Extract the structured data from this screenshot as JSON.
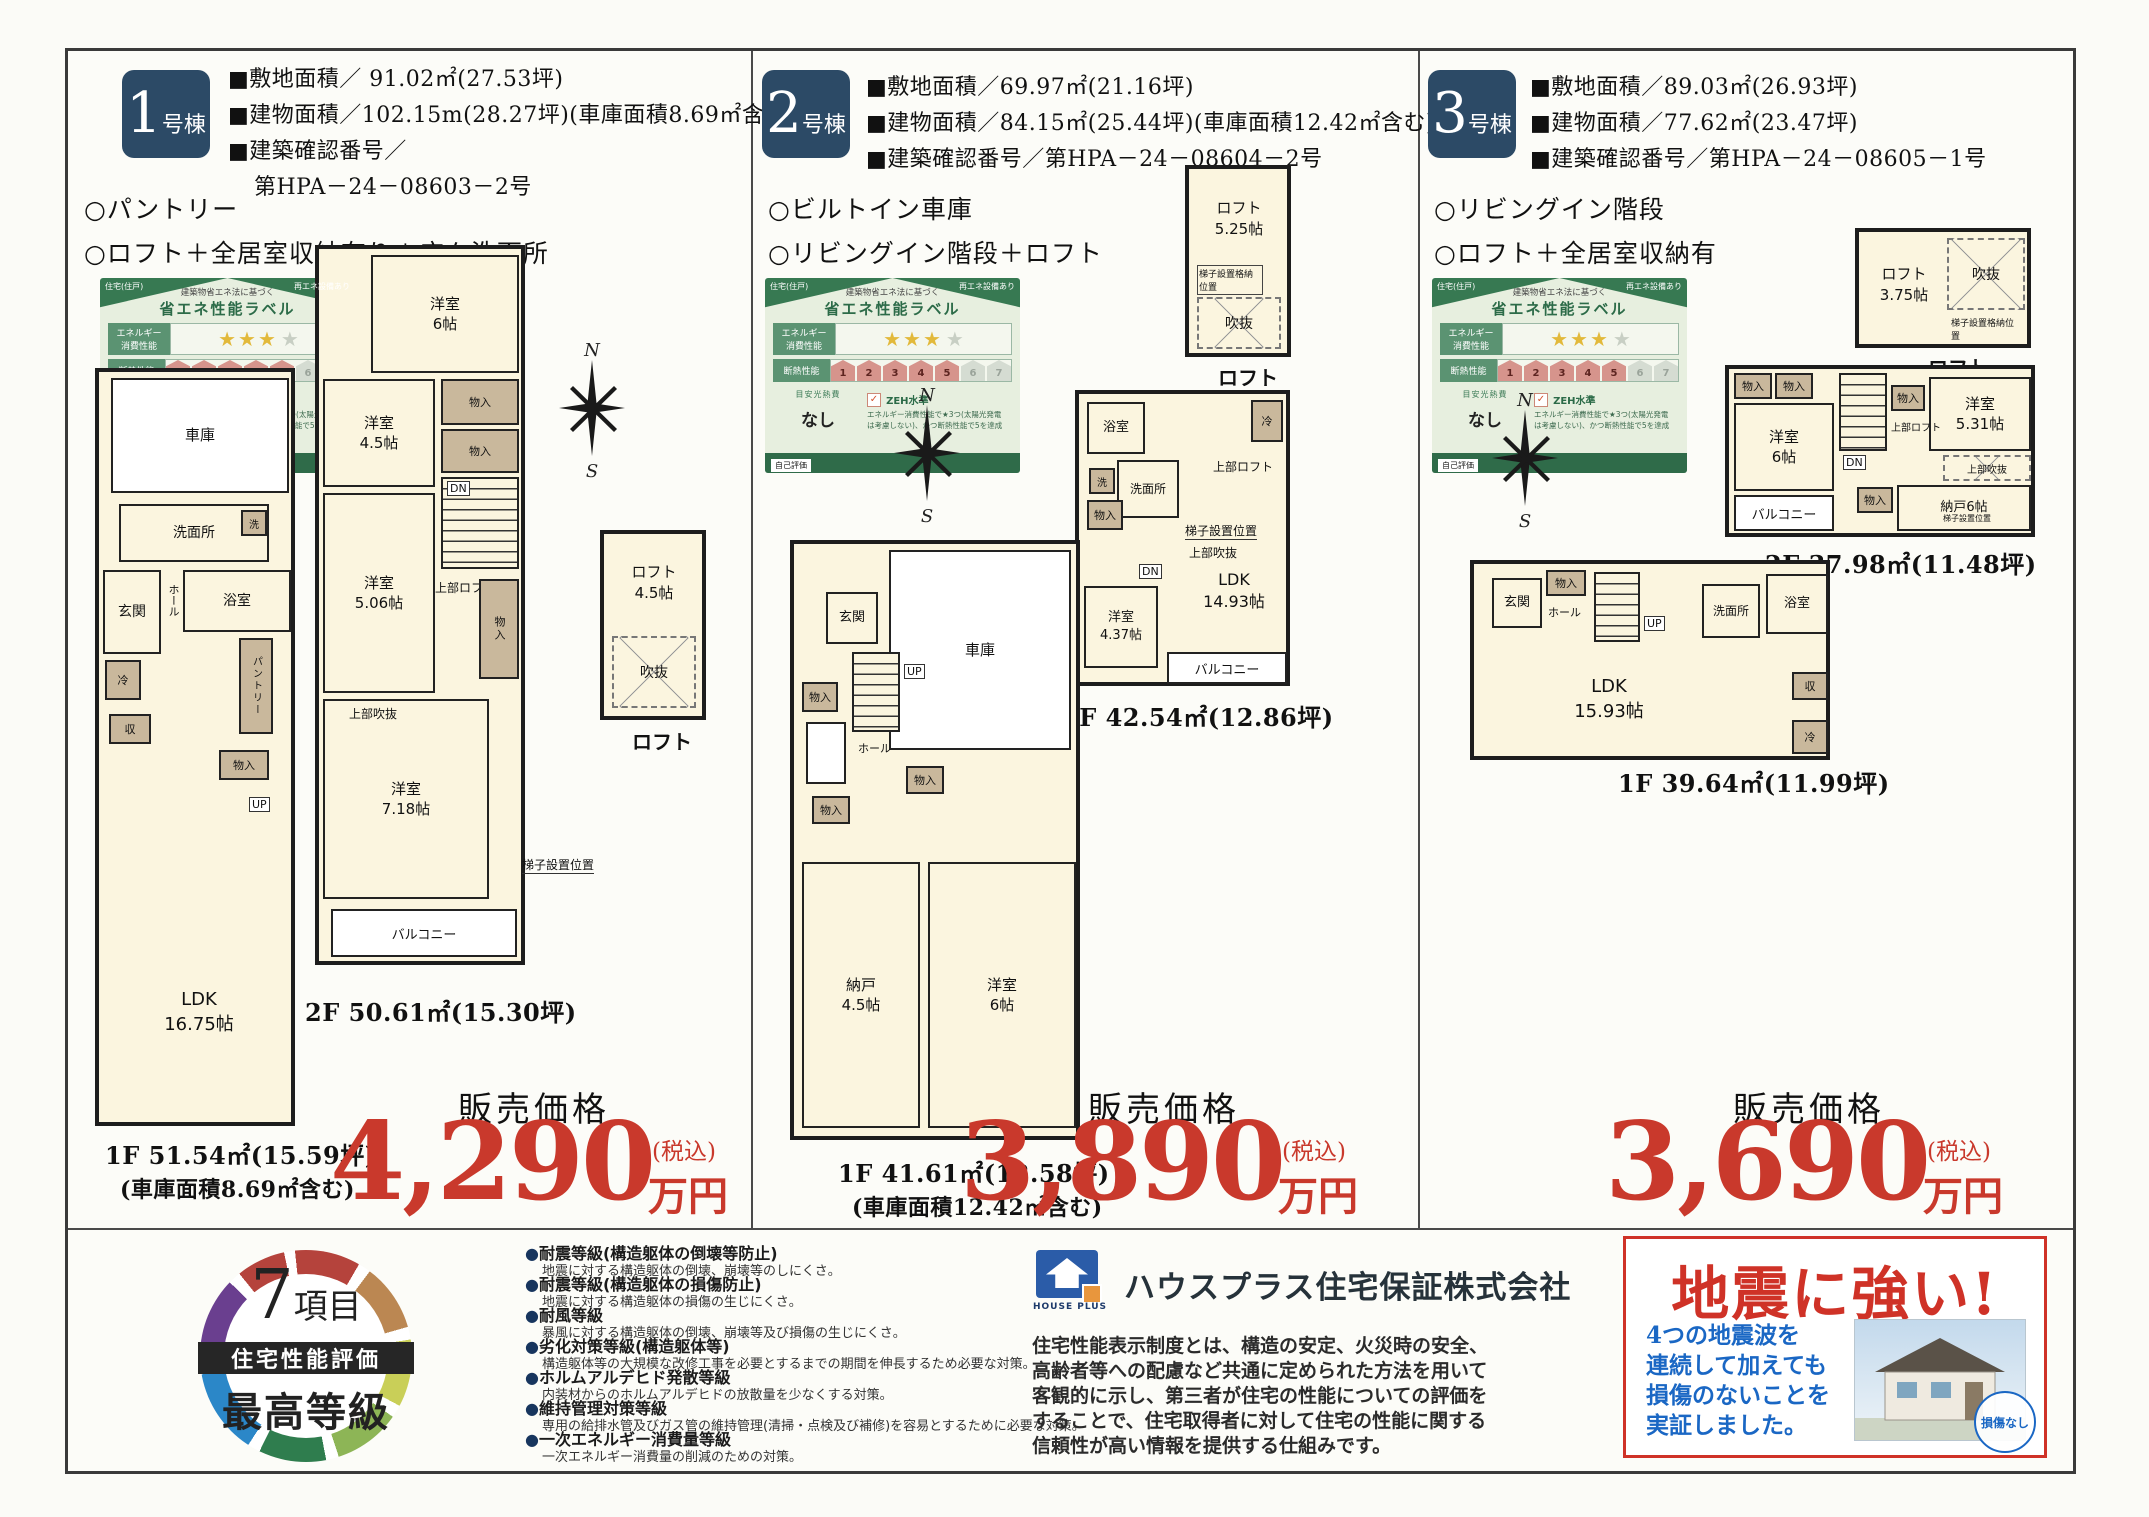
{
  "colors": {
    "navy": "#2c4a66",
    "price_red": "#c9392c",
    "label_green": "#2f6b49",
    "quake_red": "#cf3227",
    "quake_blue": "#1a67c4"
  },
  "buildings": [
    {
      "badge_num": "1",
      "badge_suffix": "号棟",
      "specs": [
        "■敷地面積／ 91.02㎡(27.53坪)",
        "■建物面積／102.15m(28.27坪)(車庫面積8.69㎡含む)",
        "■建築確認番号／",
        "第HPA－24－08603－2号"
      ],
      "features": [
        "○パントリー",
        "○ロフト＋全居室収納有り＋広々洗面所"
      ],
      "price_label": "販売価格",
      "price": "4,290",
      "tax": "(税込)",
      "unit": "万円",
      "captions": {
        "f2": "2F 50.61㎡(15.30坪)",
        "f1": "1F 51.54㎡(15.59坪)",
        "f1b": "(車庫面積8.69㎡含む)",
        "loft": "ロフト"
      },
      "rooms": {
        "y1": "洋室\n6帖",
        "y2": "洋室\n4.5帖",
        "y3": "洋室\n5.06帖",
        "y4": "洋室\n7.18帖",
        "ldk": "LDK\n16.75帖",
        "loft": "ロフト\n4.5帖"
      }
    },
    {
      "badge_num": "2",
      "badge_suffix": "号棟",
      "specs": [
        "■敷地面積／69.97㎡(21.16坪)",
        "■建物面積／84.15㎡(25.44坪)(車庫面積12.42㎡含む)",
        "■建築確認番号／第HPA－24－08604－2号"
      ],
      "features": [
        "○ビルトイン車庫",
        "○リビングイン階段＋ロフト"
      ],
      "price_label": "販売価格",
      "price": "3,890",
      "tax": "(税込)",
      "unit": "万円",
      "captions": {
        "f2": "2F 42.54㎡(12.86坪)",
        "f1": "1F 41.61㎡(12.58坪)",
        "f1b": "(車庫面積12.42㎡含む)",
        "loft": "ロフト"
      },
      "rooms": {
        "loft": "ロフト\n5.25帖",
        "ldk": "LDK\n14.93帖",
        "y1": "洋室\n4.37帖",
        "nando": "納戸\n4.5帖",
        "y2": "洋室\n6帖"
      }
    },
    {
      "badge_num": "3",
      "badge_suffix": "号棟",
      "specs": [
        "■敷地面積／89.03㎡(26.93坪)",
        "■建物面積／77.62㎡(23.47坪)",
        "■建築確認番号／第HPA－24－08605－1号"
      ],
      "features": [
        "○リビングイン階段",
        "○ロフト＋全居室収納有"
      ],
      "price_label": "販売価格",
      "price": "3,690",
      "tax": "(税込)",
      "unit": "万円",
      "captions": {
        "f2": "2F 37.98㎡(11.48坪)",
        "f1": "1F 39.64㎡(11.99坪)",
        "loft": "ロフト"
      },
      "rooms": {
        "loft": "ロフト\n3.75帖",
        "y1": "洋室\n6帖",
        "y2": "洋室\n5.31帖",
        "nando": "納戸6帖",
        "ldk": "LDK\n15.93帖"
      }
    }
  ],
  "common": {
    "mono": "物入",
    "up": "UP",
    "dn": "DN",
    "balcony": "バルコニー",
    "garage": "車庫",
    "genkan": "玄関",
    "hall": "ホール",
    "bath": "浴室",
    "senmen": "洗面所",
    "sen": "洗",
    "rei": "冷",
    "shu": "収",
    "pantry": "パントリー",
    "fukinuke": "吹抜",
    "jobu_fukinuke": "上部吹抜",
    "jobu_loft": "上部ロフト",
    "hashigo": "梯子設置位置",
    "hashigo_k": "梯子設置格納位置",
    "n": "N",
    "s": "S"
  },
  "energy": {
    "tab_l": "住宅(住戸)",
    "tab_r": "再エネ設備あり",
    "sub": "建築物省エネ法に基づく",
    "title": "省エネ性能ラベル",
    "r1": "エネルギー\n消費性能",
    "r2": "断熱性能",
    "stars": "★★★",
    "star_off": "★",
    "levels": [
      "1",
      "2",
      "3",
      "4",
      "5",
      "6",
      "7"
    ],
    "meyasu": "目安光熱費",
    "nashi": "なし",
    "zeh_check": "✓",
    "zeh": "ZEH水準",
    "zeh_note": "エネルギー消費性能で★3つ(太陽光発電\nは考慮しない)、かつ断熱性能で5を達成",
    "self": "自己評価"
  },
  "footer": {
    "bullet": "●",
    "circle": {
      "num": "7",
      "koumoku": "項目",
      "band": "住宅性能評価",
      "grade": "最高等級"
    },
    "items": [
      {
        "t": "耐震等級(構造躯体の倒壊等防止)",
        "d": "地震に対する構造躯体の倒壊、崩壊等のしにくさ。"
      },
      {
        "t": "耐震等級(構造躯体の損傷防止)",
        "d": "地震に対する構造躯体の損傷の生じにくさ。"
      },
      {
        "t": "耐風等級",
        "d": "暴風に対する構造躯体の倒壊、崩壊等及び損傷の生じにくさ。"
      },
      {
        "t": "劣化対策等級(構造躯体等)",
        "d": "構造躯体等の大規模な改修工事を必要とするまでの期間を伸長するため必要な対策。"
      },
      {
        "t": "ホルムアルデヒド発散等級",
        "d": "内装材からのホルムアルデヒドの放散量を少なくする対策。"
      },
      {
        "t": "維持管理対策等級",
        "d": "専用の給排水管及びガス管の維持管理(清掃・点検及び補修)を容易とするために必要な対策。"
      },
      {
        "t": "一次エネルギー消費量等級",
        "d": "一次エネルギー消費量の削減のための対策。"
      }
    ],
    "company": {
      "logo": "HOUSE PLUS",
      "name": "ハウスプラス住宅保証株式会社",
      "desc": "住宅性能表示制度とは、構造の安定、火災時の安全、\n高齢者等への配慮など共通に定められた方法を用いて\n客観的に示し、第三者が住宅の性能についての評価を\nすることで、住宅取得者に対して住宅の性能に関する\n信頼性が高い情報を提供する仕組みです。"
    },
    "quake": {
      "title": "地震に強い!",
      "body": "4つの地震波を\n連続して加えても\n損傷のないことを\n実証しました。",
      "badge": "損傷なし"
    }
  }
}
